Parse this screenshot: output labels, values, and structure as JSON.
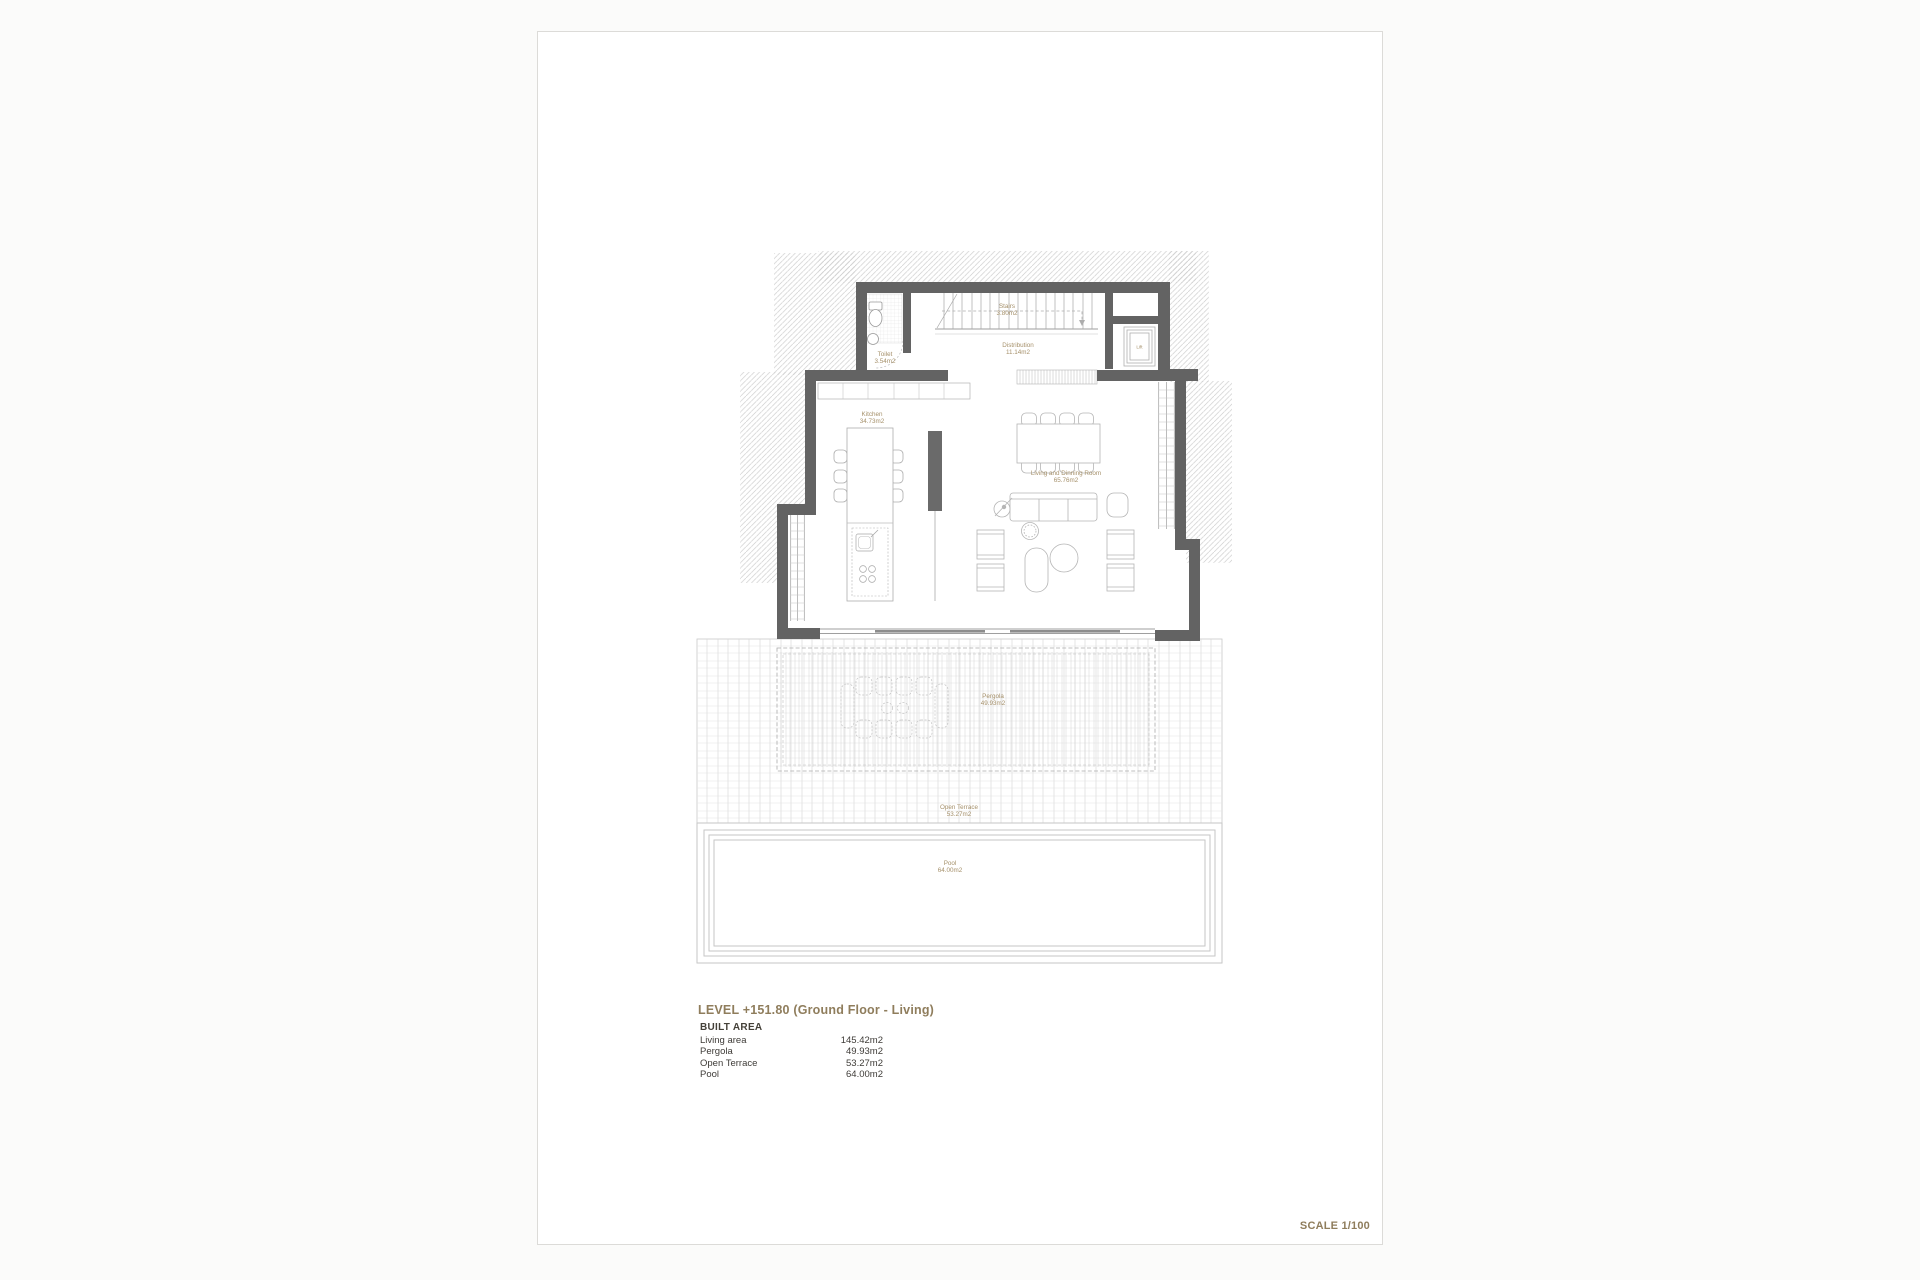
{
  "sheet": {
    "title": "LEVEL +151.80 (Ground Floor - Living)",
    "scale_label": "SCALE 1/100",
    "built_area": {
      "heading": "BUILT AREA",
      "rows": [
        {
          "label": "Living area",
          "value": "145.42m2"
        },
        {
          "label": "Pergola",
          "value": "49.93m2"
        },
        {
          "label": "Open Terrace",
          "value": "53.27m2"
        },
        {
          "label": "Pool",
          "value": "64.00m2"
        }
      ]
    }
  },
  "plan": {
    "labels": {
      "toilet": {
        "name": "Toilet",
        "area": "3.54m2"
      },
      "stairs": {
        "name": "Stairs",
        "area": "3.80m2"
      },
      "distribution": {
        "name": "Distribution",
        "area": "11.14m2"
      },
      "lift": {
        "name": "Lift"
      },
      "kitchen": {
        "name": "Kitchen",
        "area": "34.73m2"
      },
      "living": {
        "name": "Living and Dinning Room",
        "area": "65.76m2"
      },
      "pergola": {
        "name": "Pergola",
        "area": "49.93m2"
      },
      "open_terrace": {
        "name": "Open Terrace",
        "area": "53.27m2"
      },
      "pool": {
        "name": "Pool",
        "area": "64.00m2"
      }
    }
  },
  "colors": {
    "accent_text": "#8f7d5c",
    "room_label": "#a5906a",
    "wall": "#636363"
  }
}
